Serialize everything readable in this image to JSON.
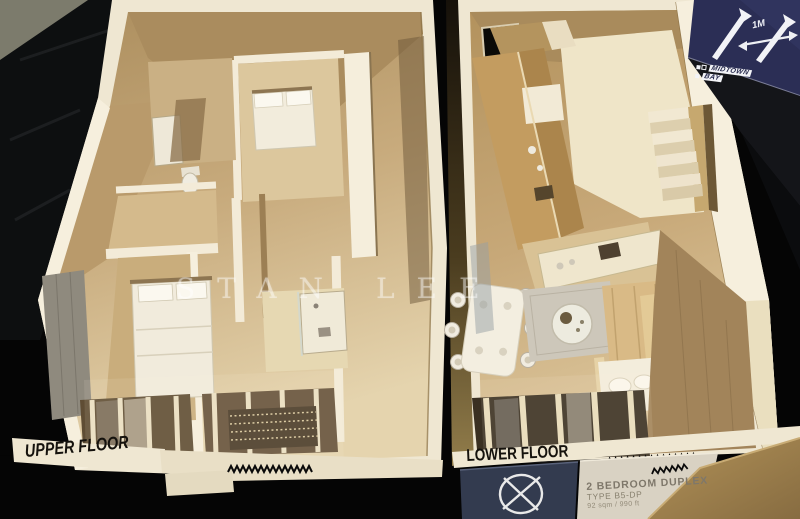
{
  "watermark": {
    "text": "STAN LEE"
  },
  "floor_labels": {
    "upper": "UPPER FLOOR",
    "lower": "LOWER FLOOR"
  },
  "plaque": {
    "title": "2 BEDROOM DUPLEX",
    "type_code": "TYPE B5-DP",
    "area": "92 sqm / 990 ft"
  },
  "sign": {
    "scale_label": "1M",
    "brand_line1": "MIDTOWN",
    "brand_line2": "BAY"
  },
  "icons": {
    "north_arrow": "north-arrow-icon",
    "scale_arrow": "scale-arrow-icon",
    "compass": "compass-icon"
  },
  "colors": {
    "background": "#060606",
    "wall_cream": "#efe7d2",
    "floor_tan": "#c2a374",
    "wood_dark": "#a5875b",
    "sign_navy": "#2b2e55",
    "plate_navy": "#333b4f",
    "plate_beige": "#d9d2c3",
    "label_text": "#15120d"
  }
}
